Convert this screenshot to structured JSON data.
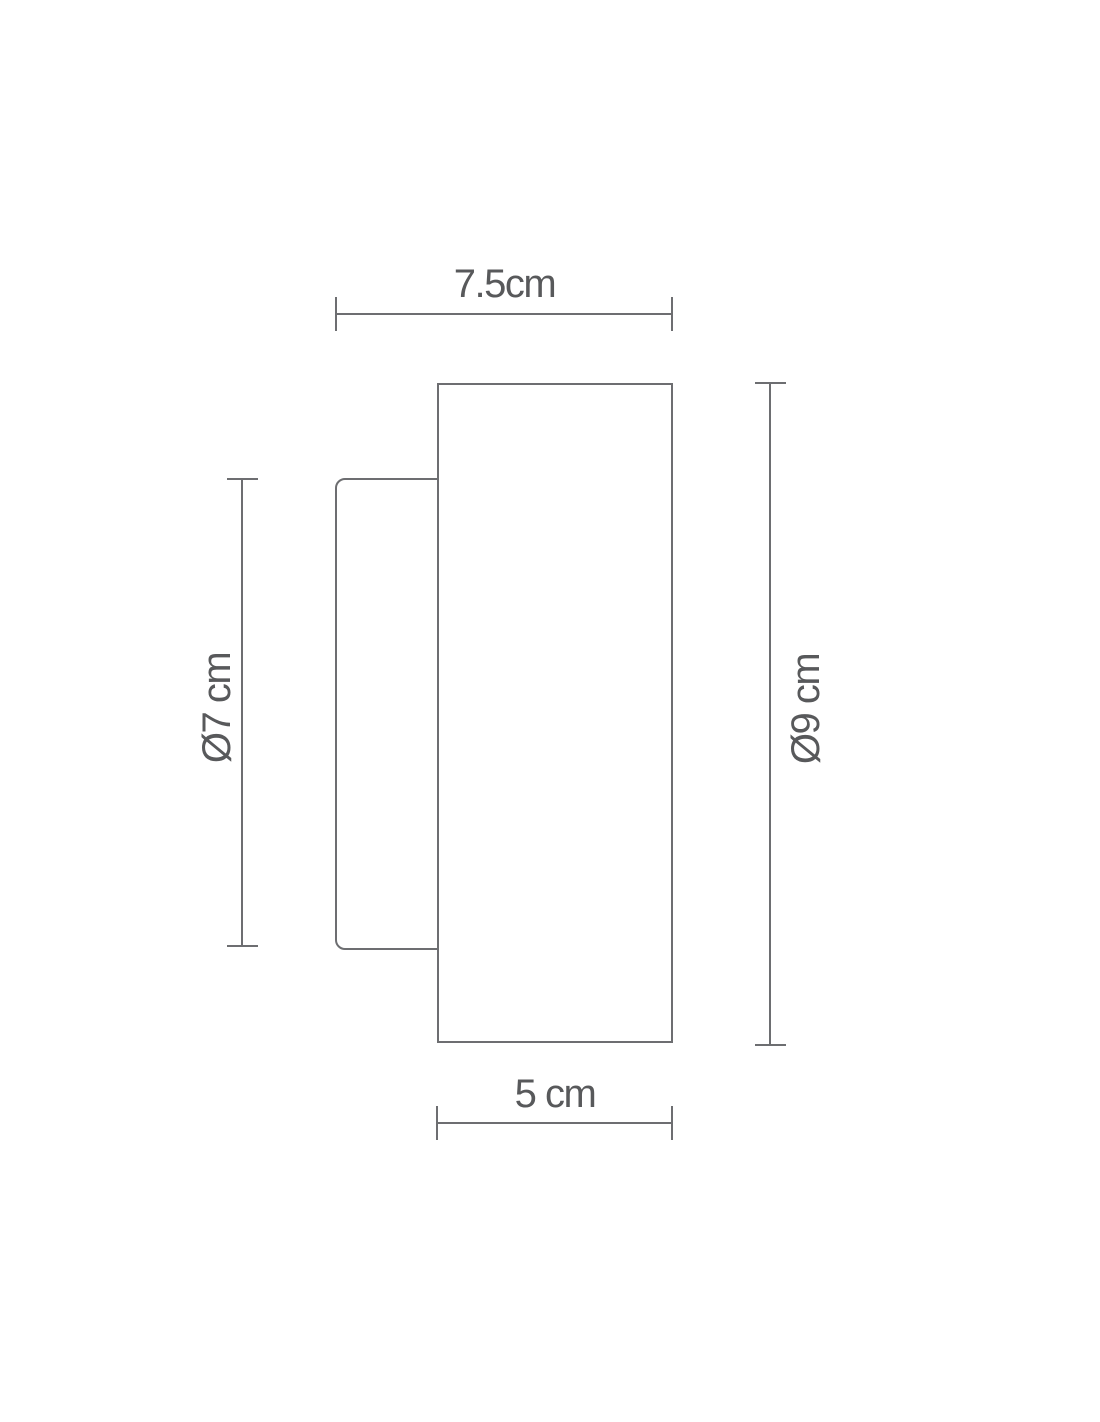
{
  "diagram": {
    "colors": {
      "background": "#ffffff",
      "stroke": "#6d6e71",
      "text": "#58595b"
    },
    "dimensions": {
      "top_width": {
        "label": "7.5cm"
      },
      "body_width": {
        "label": "5 cm"
      },
      "plate_height": {
        "label": "Ø7 cm"
      },
      "body_height": {
        "label": "Ø9 cm"
      }
    }
  }
}
